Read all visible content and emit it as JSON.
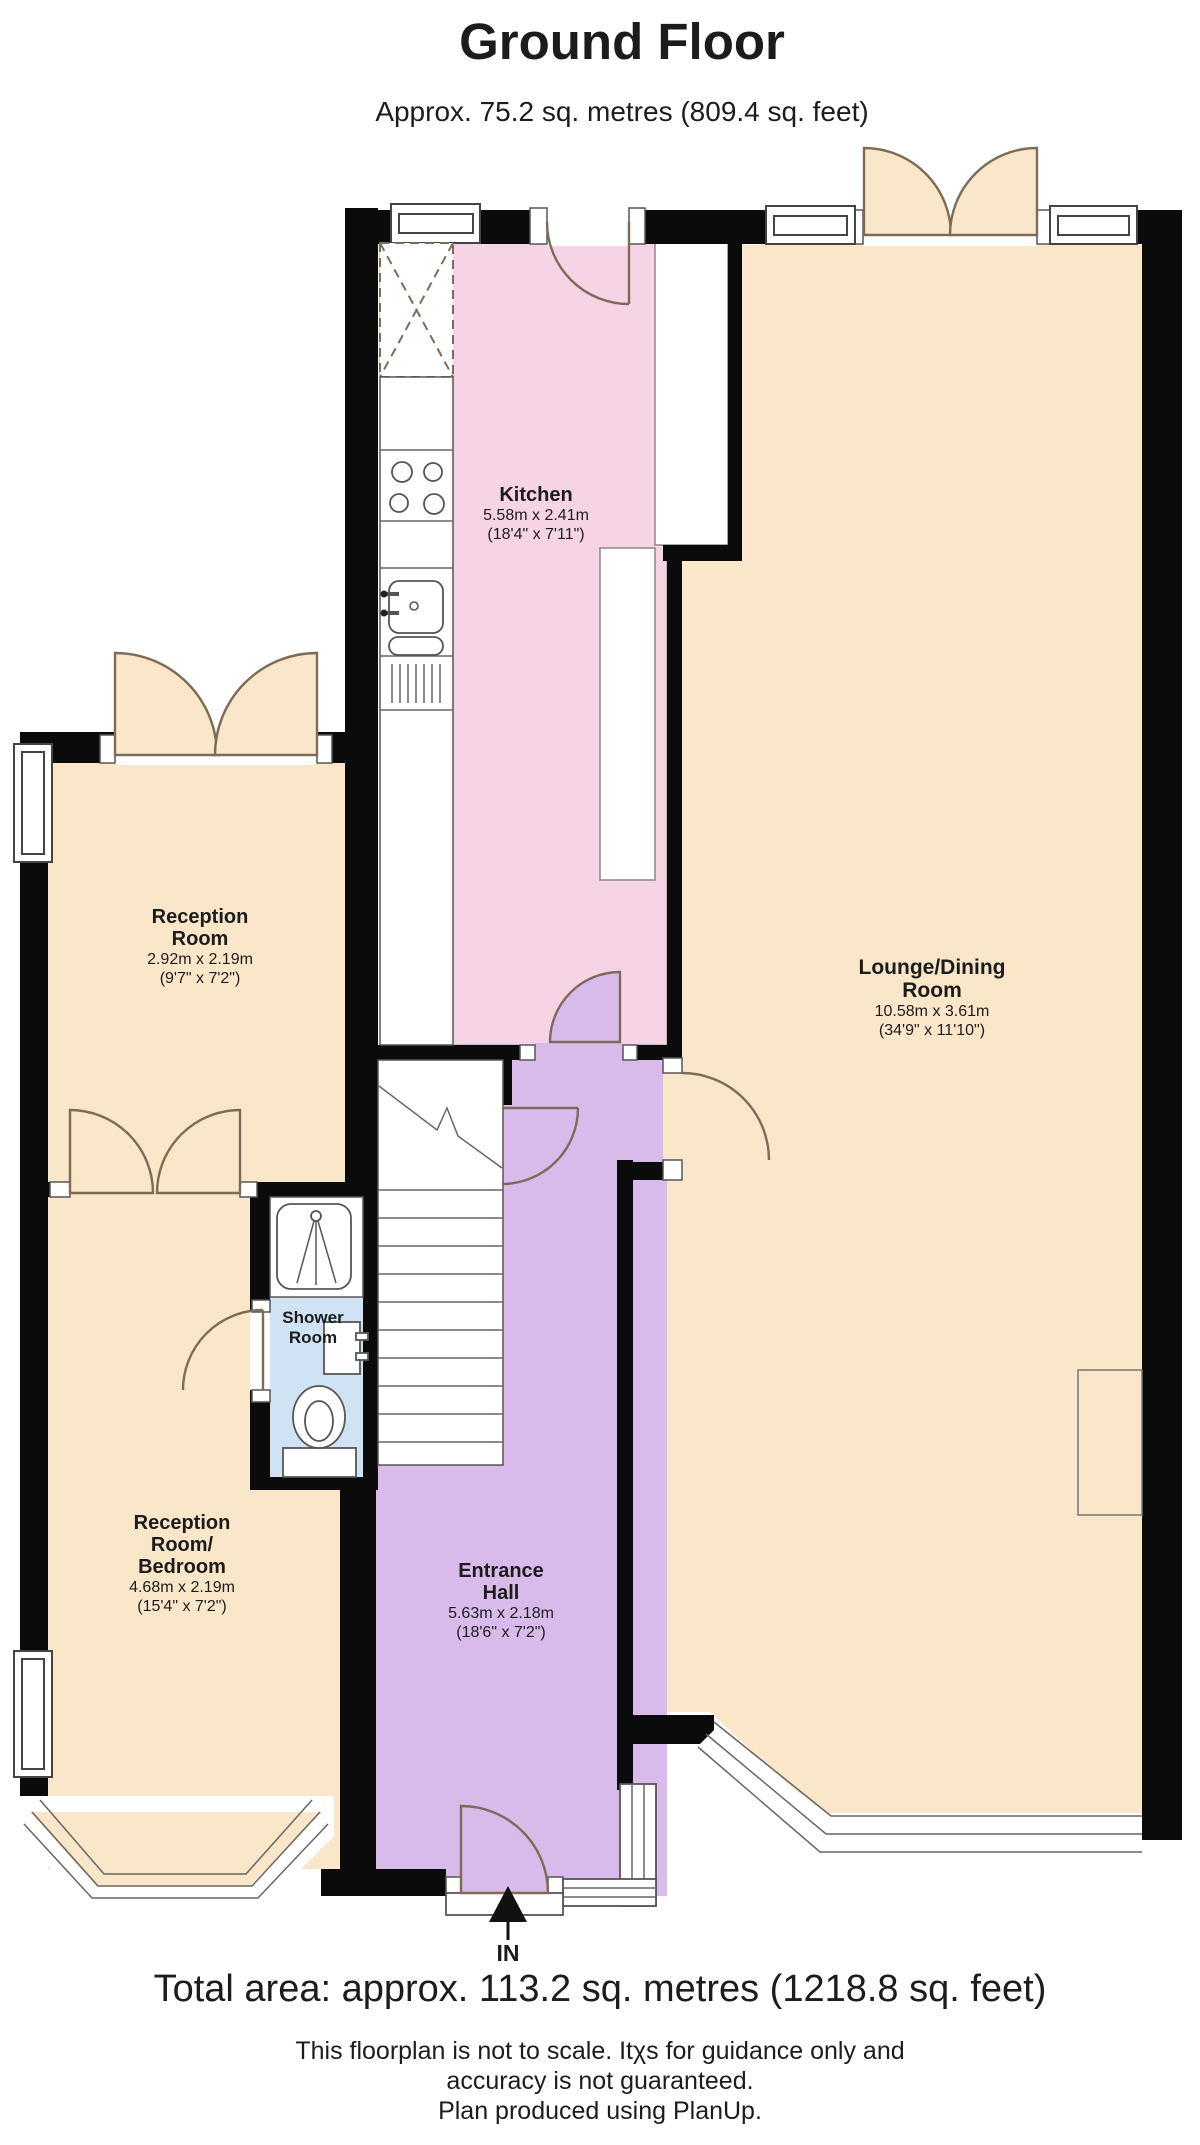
{
  "header": {
    "title": "Ground Floor",
    "subtitle": "Approx. 75.2 sq. metres (809.4 sq. feet)"
  },
  "rooms": {
    "kitchen": {
      "name": "Kitchen",
      "metric": "5.58m x 2.41m",
      "imperial": "(18'4\" x 7'11\")"
    },
    "lounge": {
      "name_line1": "Lounge/Dining",
      "name_line2": "Room",
      "metric": "10.58m x 3.61m",
      "imperial": "(34'9\" x 11'10\")"
    },
    "reception": {
      "name_line1": "Reception",
      "name_line2": "Room",
      "metric": "2.92m x 2.19m",
      "imperial": "(9'7\" x 7'2\")"
    },
    "reception_bedroom": {
      "name_line1": "Reception",
      "name_line2": "Room/",
      "name_line3": "Bedroom",
      "metric": "4.68m x 2.19m",
      "imperial": "(15'4\" x 7'2\")"
    },
    "entrance_hall": {
      "name_line1": "Entrance",
      "name_line2": "Hall",
      "metric": "5.63m x 2.18m",
      "imperial": "(18'6\" x 7'2\")"
    },
    "shower_room": {
      "name_line1": "Shower",
      "name_line2": "Room"
    }
  },
  "entry_marker": {
    "label": "IN"
  },
  "footer": {
    "total_area": "Total area: approx. 113.2 sq. metres (1218.8 sq. feet)",
    "disclaimer_line1": "This floorplan is not to scale. Itχs for guidance only and",
    "disclaimer_line2": "accuracy is not guaranteed.",
    "disclaimer_line3": "Plan produced using PlanUp."
  },
  "colors": {
    "wall": "#0b0b0b",
    "lounge": "#fae6c9",
    "kitchen": "#f7d3e6",
    "hall": "#d8bbea",
    "shower": "#cfe3f4",
    "door": "#7d6b58"
  }
}
